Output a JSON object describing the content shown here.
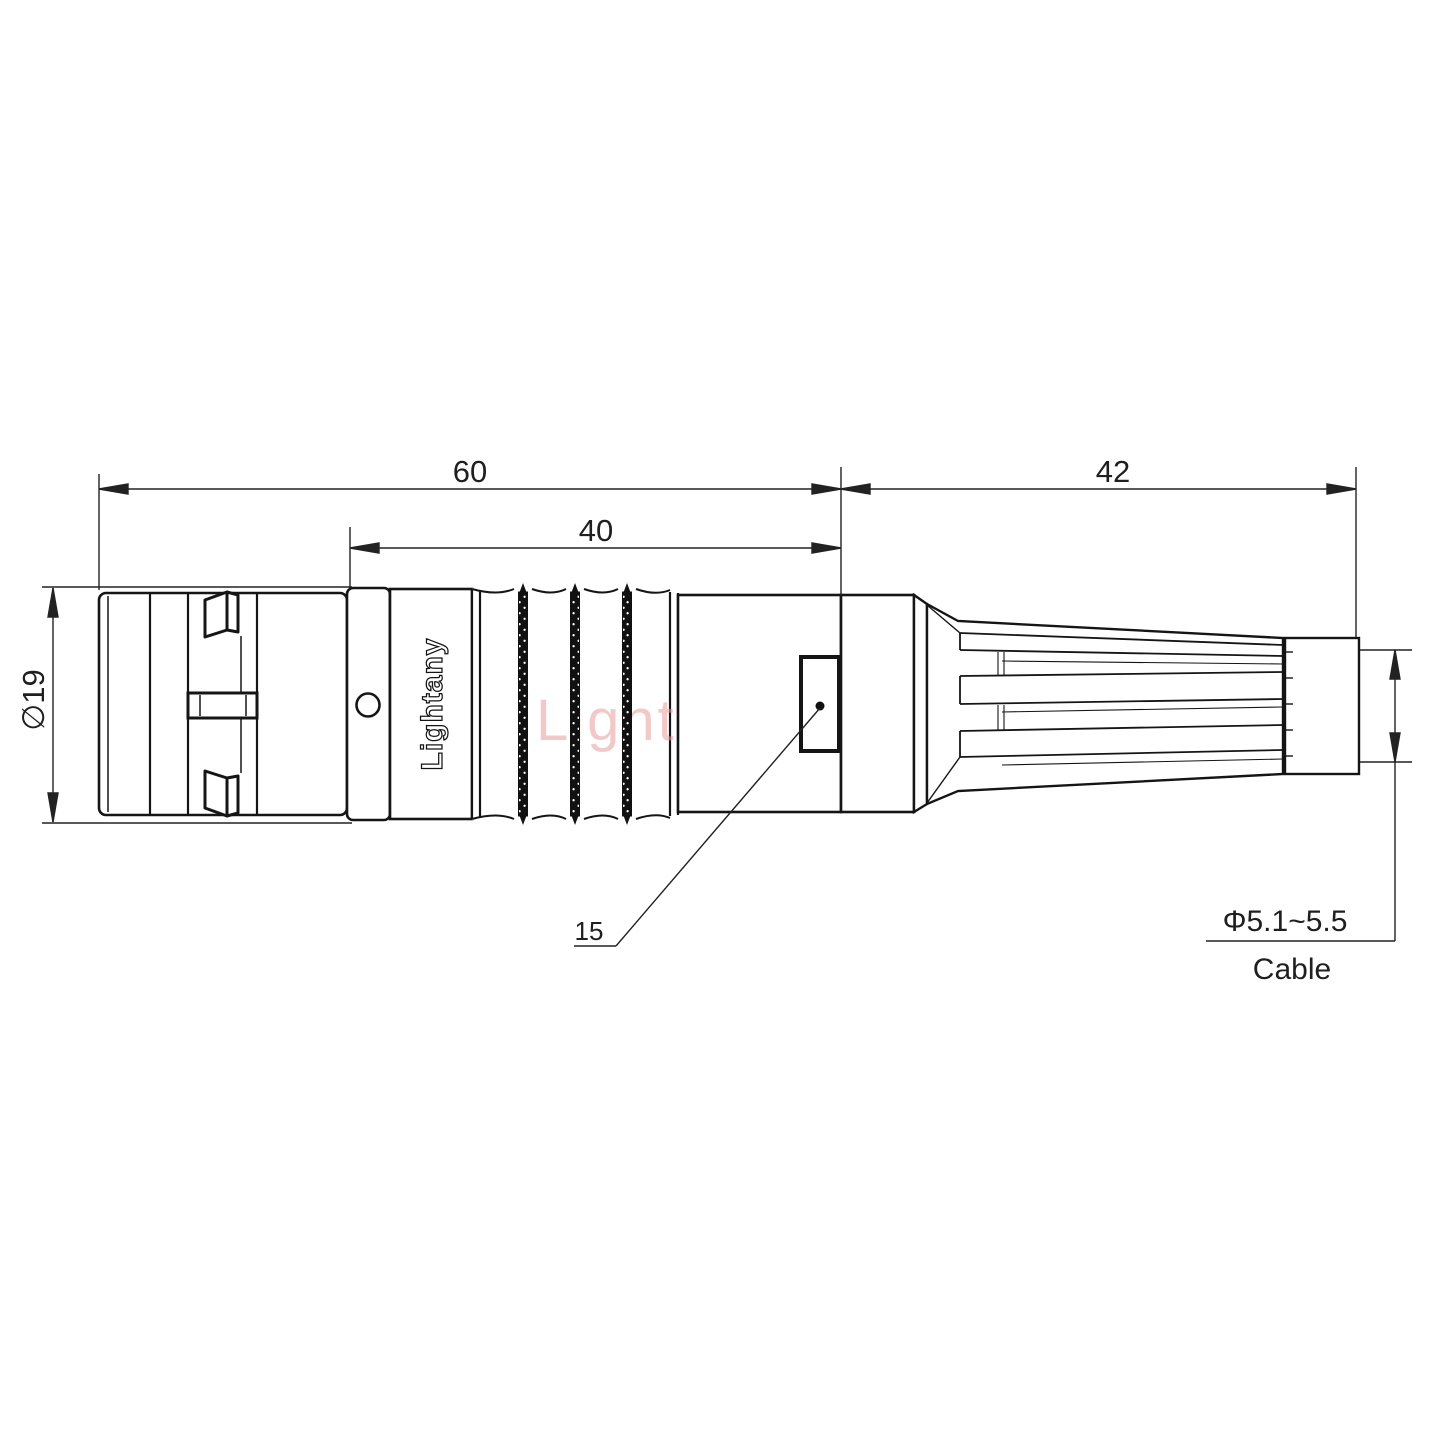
{
  "drawing": {
    "watermark": "Lightany",
    "brand_engraving": "Lightany",
    "dimensions": {
      "overall_front_length": "60",
      "body_section_length": "40",
      "boot_section_length": "42",
      "outer_diameter": "∅19",
      "latch_detail": "15",
      "cable_diameter_range": "Φ5.1~5.5",
      "cable_caption": "Cable"
    },
    "colors": {
      "line": "#151515",
      "dimension_line": "#222222",
      "knurl_fill": "#111111",
      "watermark": "#e79d9d",
      "background": "#ffffff"
    }
  }
}
